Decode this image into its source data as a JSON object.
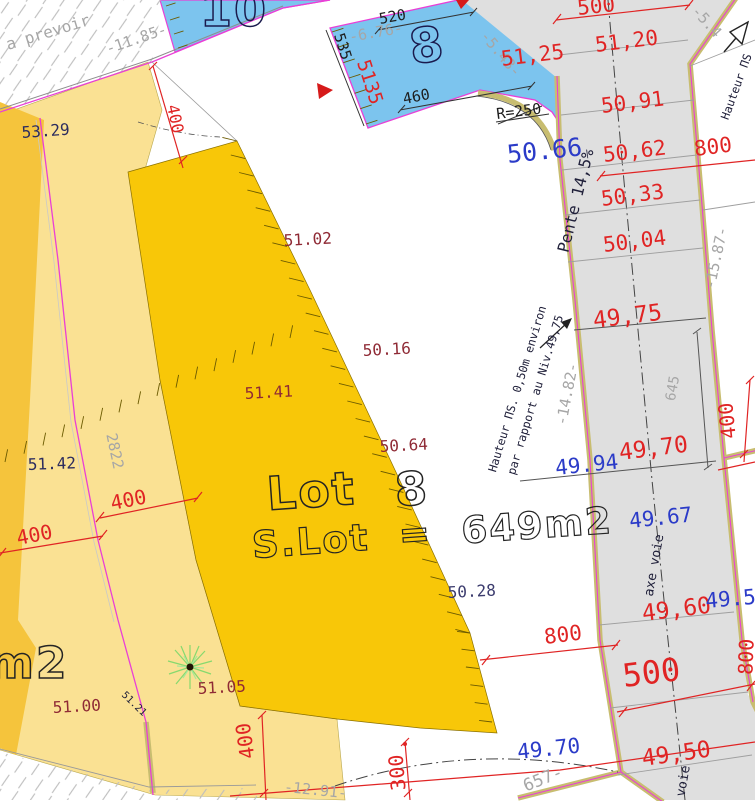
{
  "document": {
    "type": "cadastral-subdivision-plan"
  },
  "colors": {
    "red": "#E02424",
    "blue": "#2B3BC8",
    "maroon": "#8F2A35",
    "navy": "#2C2C5E",
    "slate": "#3C3C6E",
    "lgray": "#A6A6A6",
    "dark": "#20203A",
    "black": "#1D1D1D",
    "outlineNavy": "#1A1A4D",
    "outlineBlack": "#242424",
    "parcelYellow": "#FAE193",
    "parcelAmber": "#F8C708",
    "parcelBlue": "#7CC4EE",
    "roadGray": "#DFDFDF",
    "curbTan": "#C8BD70",
    "boundaryMagenta": "#E93FD6",
    "treeGreen": "#86D96E"
  },
  "labels": [
    {
      "n": "lot10-number",
      "t": "10",
      "x": 200,
      "y": 26,
      "r": 0,
      "s": 46,
      "c": "outlineNavy",
      "o": 1
    },
    {
      "n": "note-a-prevoir",
      "t": "a prevoir",
      "x": 8,
      "y": 50,
      "r": -17,
      "s": 16,
      "c": "lgray"
    },
    {
      "n": "dim-1185",
      "t": "-11.85-",
      "x": 108,
      "y": 54,
      "r": -19,
      "s": 15,
      "c": "lgray"
    },
    {
      "n": "spot-5329",
      "t": "53.29",
      "x": 22,
      "y": 138,
      "r": -4,
      "s": 16,
      "c": "navy"
    },
    {
      "n": "dim-400-top",
      "t": "400",
      "x": 170,
      "y": 120,
      "r": 78,
      "s": 16,
      "c": "red",
      "a": "m"
    },
    {
      "n": "dim-535",
      "t": "535",
      "x": 338,
      "y": 48,
      "r": 72,
      "s": 15,
      "c": "black",
      "a": "m"
    },
    {
      "n": "dim-5135",
      "t": "5135",
      "x": 364,
      "y": 84,
      "r": 72,
      "s": 19,
      "c": "red",
      "a": "m"
    },
    {
      "n": "dim-520",
      "t": "520",
      "x": 380,
      "y": 24,
      "r": -10,
      "s": 15,
      "c": "black"
    },
    {
      "n": "dim-676",
      "t": "-6.76-",
      "x": 350,
      "y": 42,
      "r": -10,
      "s": 15,
      "c": "lgray"
    },
    {
      "n": "lot8-number-blue",
      "t": "8",
      "x": 412,
      "y": 64,
      "r": -8,
      "s": 48,
      "c": "outlineNavy",
      "o": 1
    },
    {
      "n": "dim-543",
      "t": "-5.43-",
      "x": 497,
      "y": 57,
      "r": 50,
      "s": 15,
      "c": "lgray",
      "a": "m"
    },
    {
      "n": "spot-5125",
      "t": "51,25",
      "x": 502,
      "y": 66,
      "r": -7,
      "s": 21,
      "c": "red"
    },
    {
      "n": "dim-460",
      "t": "460",
      "x": 404,
      "y": 104,
      "r": -11,
      "s": 15,
      "c": "black"
    },
    {
      "n": "radius-r250",
      "t": "R=250",
      "x": 497,
      "y": 119,
      "r": -7,
      "s": 15,
      "c": "black"
    },
    {
      "n": "spot-5066",
      "t": "50.66",
      "x": 508,
      "y": 163,
      "r": -6,
      "s": 25,
      "c": "blue"
    },
    {
      "n": "dim-500-top",
      "t": "500",
      "x": 578,
      "y": 15,
      "r": -6,
      "s": 21,
      "c": "red"
    },
    {
      "n": "dim-54-topright",
      "t": "-5.4",
      "x": 703,
      "y": 25,
      "r": 48,
      "s": 15,
      "c": "lgray",
      "a": "m"
    },
    {
      "n": "spot-5120",
      "t": "51,20",
      "x": 596,
      "y": 52,
      "r": -7,
      "s": 21,
      "c": "red"
    },
    {
      "n": "spot-5091",
      "t": "50,91",
      "x": 602,
      "y": 113,
      "r": -7,
      "s": 21,
      "c": "red"
    },
    {
      "n": "spot-5062",
      "t": "50,62",
      "x": 604,
      "y": 162,
      "r": -7,
      "s": 21,
      "c": "red"
    },
    {
      "n": "dim-800-topright",
      "t": "800",
      "x": 695,
      "y": 156,
      "r": -7,
      "s": 21,
      "c": "red"
    },
    {
      "n": "spot-5033",
      "t": "50,33",
      "x": 602,
      "y": 206,
      "r": -7,
      "s": 21,
      "c": "red"
    },
    {
      "n": "spot-5004",
      "t": "50,04",
      "x": 604,
      "y": 252,
      "r": -7,
      "s": 21,
      "c": "red"
    },
    {
      "n": "slope-pente",
      "t": "Pente 14,5%",
      "x": 581,
      "y": 202,
      "r": -76,
      "s": 16,
      "c": "dark",
      "a": "m"
    },
    {
      "n": "dim-1587",
      "t": "-15.87-",
      "x": 721,
      "y": 259,
      "r": -78,
      "s": 15,
      "c": "lgray",
      "a": "m"
    },
    {
      "n": "spot-4975",
      "t": "49,75",
      "x": 594,
      "y": 328,
      "r": -7,
      "s": 23,
      "c": "red"
    },
    {
      "n": "note-hauteur-1",
      "t": "Hauteur ΠS. 0,50m environ",
      "x": 521,
      "y": 390,
      "r": -73,
      "s": 11.5,
      "c": "dark",
      "a": "m"
    },
    {
      "n": "note-hauteur-2",
      "t": "par rapport au Niv.49,75",
      "x": 539,
      "y": 396,
      "r": -73,
      "s": 11.5,
      "c": "dark",
      "a": "m"
    },
    {
      "n": "dim-1482",
      "t": "-14.82-",
      "x": 572,
      "y": 395,
      "r": -79,
      "s": 15,
      "c": "lgray",
      "a": "m"
    },
    {
      "n": "dim-645",
      "t": "645",
      "x": 677,
      "y": 389,
      "r": -80,
      "s": 14,
      "c": "lgray",
      "a": "m"
    },
    {
      "n": "spot-5102",
      "t": "51.02",
      "x": 284,
      "y": 246,
      "r": -3,
      "s": 16,
      "c": "maroon"
    },
    {
      "n": "spot-5016",
      "t": "50.16",
      "x": 363,
      "y": 356,
      "r": -3,
      "s": 16,
      "c": "maroon"
    },
    {
      "n": "spot-5141",
      "t": "51.41",
      "x": 245,
      "y": 399,
      "r": -3,
      "s": 16,
      "c": "maroon"
    },
    {
      "n": "spot-5064",
      "t": "50.64",
      "x": 380,
      "y": 452,
      "r": -3,
      "s": 16,
      "c": "maroon"
    },
    {
      "n": "spot-5142",
      "t": "51.42",
      "x": 28,
      "y": 470,
      "r": -2,
      "s": 16,
      "c": "navy"
    },
    {
      "n": "dim-2822",
      "t": "2822",
      "x": 110,
      "y": 452,
      "r": 78,
      "s": 15,
      "c": "lgray",
      "a": "m"
    },
    {
      "n": "dim-400-left-upper",
      "t": "400",
      "x": 112,
      "y": 510,
      "r": -11,
      "s": 20,
      "c": "red"
    },
    {
      "n": "dim-400-left-lower",
      "t": "400",
      "x": 18,
      "y": 545,
      "r": -11,
      "s": 20,
      "c": "red"
    },
    {
      "n": "lot8-label-word",
      "t": "Lot",
      "x": 268,
      "y": 510,
      "r": -4,
      "s": 46,
      "c": "outlineBlack",
      "o": 1
    },
    {
      "n": "lot8-label-number",
      "t": "8",
      "x": 396,
      "y": 506,
      "r": -4,
      "s": 46,
      "c": "outlineBlack",
      "o": 1
    },
    {
      "n": "lot8-area-label",
      "t": "S.Lot  =  649m2",
      "x": 253,
      "y": 558,
      "r": -4,
      "s": 37,
      "c": "outlineBlack",
      "o": 1
    },
    {
      "n": "spot-5028",
      "t": "50.28",
      "x": 448,
      "y": 598,
      "r": -3,
      "s": 16,
      "c": "slate"
    },
    {
      "n": "spot-4994",
      "t": "49.94",
      "x": 556,
      "y": 475,
      "r": -6,
      "s": 21,
      "c": "blue"
    },
    {
      "n": "spot-4970-road",
      "t": "49,70",
      "x": 620,
      "y": 460,
      "r": -7,
      "s": 23,
      "c": "red"
    },
    {
      "n": "spot-4967",
      "t": "49.67",
      "x": 630,
      "y": 528,
      "r": -6,
      "s": 21,
      "c": "blue"
    },
    {
      "n": "road-axis-label",
      "t": "axe voie",
      "x": 658,
      "y": 566,
      "r": -80,
      "s": 13,
      "c": "dark",
      "a": "m"
    },
    {
      "n": "spot-4960",
      "t": "49,60",
      "x": 643,
      "y": 621,
      "r": -7,
      "s": 23,
      "c": "red"
    },
    {
      "n": "spot-495-partial",
      "t": "49.5",
      "x": 706,
      "y": 608,
      "r": -5,
      "s": 21,
      "c": "blue"
    },
    {
      "n": "dim-800-mid",
      "t": "800",
      "x": 545,
      "y": 644,
      "r": -7,
      "s": 21,
      "c": "red"
    },
    {
      "n": "dim-500-bottom",
      "t": "500",
      "x": 624,
      "y": 687,
      "r": -7,
      "s": 32,
      "c": "red"
    },
    {
      "n": "spot-4950",
      "t": "49,50",
      "x": 643,
      "y": 766,
      "r": -8,
      "s": 23,
      "c": "red"
    },
    {
      "n": "spot-4970-bottom",
      "t": "49.70",
      "x": 518,
      "y": 759,
      "r": -6,
      "s": 21,
      "c": "blue"
    },
    {
      "n": "dim-657",
      "t": "657-",
      "x": 545,
      "y": 784,
      "r": -22,
      "s": 17,
      "c": "lgray",
      "a": "m"
    },
    {
      "n": "dim-1291",
      "t": "-12.91-",
      "x": 315,
      "y": 795,
      "r": 6,
      "s": 15,
      "c": "lgray",
      "a": "m"
    },
    {
      "n": "dim-300",
      "t": "300",
      "x": 404,
      "y": 772,
      "r": -95,
      "s": 20,
      "c": "red",
      "a": "m"
    },
    {
      "n": "dim-400-bottom",
      "t": "400",
      "x": 252,
      "y": 740,
      "r": -98,
      "s": 20,
      "c": "red",
      "a": "m"
    },
    {
      "n": "dim-400-right",
      "t": "400",
      "x": 734,
      "y": 420,
      "r": -96,
      "s": 20,
      "c": "red",
      "a": "m"
    },
    {
      "n": "adjacent-lot-area-partial",
      "t": "m2",
      "x": -12,
      "y": 678,
      "r": 0,
      "s": 44,
      "c": "outlineBlack",
      "o": 1
    },
    {
      "n": "spot-5100",
      "t": "51.00",
      "x": 53,
      "y": 713,
      "r": -3,
      "s": 16,
      "c": "maroon"
    },
    {
      "n": "spot-5105",
      "t": "51.05",
      "x": 198,
      "y": 694,
      "r": -3,
      "s": 16,
      "c": "maroon"
    },
    {
      "n": "spot-5121",
      "t": "51.21",
      "x": 132,
      "y": 706,
      "r": 44,
      "s": 10,
      "c": "dark",
      "a": "m"
    },
    {
      "n": "note-hauteur-right-partial",
      "t": "Hauteur ΠS",
      "x": 740,
      "y": 88,
      "r": -70,
      "s": 11.5,
      "c": "dark",
      "a": "m"
    },
    {
      "n": "dim-800-right-partial",
      "t": "800",
      "x": 753,
      "y": 657,
      "r": -88,
      "s": 20,
      "c": "red",
      "a": "m"
    },
    {
      "n": "road-axis-label-partial",
      "t": "axe voie",
      "x": 679,
      "y": 828,
      "r": -80,
      "s": 13,
      "c": "dark"
    }
  ]
}
